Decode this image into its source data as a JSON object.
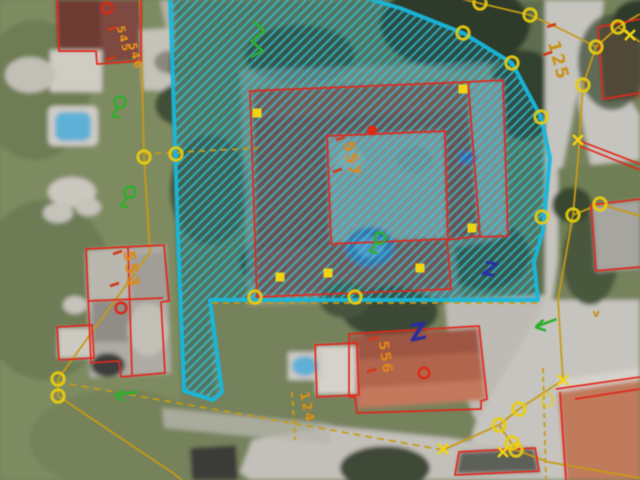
{
  "map": {
    "type": "cadastral-aerial-orthophoto",
    "colors": {
      "selection_border": "#17b9de",
      "selection_hatch": "#35cde8",
      "boundary_line": "#c79a17",
      "building_outline": "#e3271c",
      "marker_yellow": "#f2d414",
      "marker_ring": "#e8cd10",
      "building_ring_red": "#e02714",
      "vegetation_green": "#2fae2e",
      "annotation_blue": "#2a2fa0",
      "label_orange": "#e08818"
    },
    "parcel_labels": [
      {
        "text": "125",
        "x": 553,
        "y": 62,
        "rot": 75,
        "size": 17,
        "color": "#c7921a",
        "ticks": [
          [
            547,
            27
          ],
          [
            543,
            55
          ]
        ]
      },
      {
        "text": "553",
        "x": 126,
        "y": 270,
        "rot": 82,
        "size": 16,
        "color": "#e08818",
        "ticks": [
          [
            113,
            254
          ],
          [
            110,
            286
          ]
        ]
      },
      {
        "text": "557",
        "x": 347,
        "y": 160,
        "rot": 78,
        "size": 15,
        "color": "#e08818",
        "ticks": [
          [
            336,
            140
          ],
          [
            333,
            172
          ]
        ]
      },
      {
        "text": "556",
        "x": 381,
        "y": 358,
        "rot": 82,
        "size": 14,
        "color": "#e08818",
        "ticks": [
          [
            369,
            340
          ],
          [
            367,
            372
          ]
        ]
      },
      {
        "text": "124",
        "x": 303,
        "y": 408,
        "rot": 78,
        "size": 13,
        "color": "#d89010",
        "ticks": []
      },
      {
        "text": "545",
        "x": 120,
        "y": 40,
        "rot": 76,
        "size": 11,
        "color": "#e89418",
        "ticks": [
          [
            108,
            30
          ]
        ]
      },
      {
        "text": "546",
        "x": 132,
        "y": 57,
        "rot": 76,
        "size": 11,
        "color": "#e89418",
        "ticks": [
          [
            106,
            60
          ]
        ]
      },
      {
        "text": "v",
        "x": 597,
        "y": 317,
        "rot": 0,
        "size": 11,
        "color": "#c78a14",
        "ticks": []
      }
    ],
    "symbols": [
      {
        "name": "orchard-tree-symbol",
        "x": 120,
        "y": 102,
        "rot": -15
      },
      {
        "name": "orchard-tree-symbol",
        "x": 130,
        "y": 192,
        "rot": -10
      },
      {
        "name": "orchard-tree-symbol",
        "x": 380,
        "y": 238,
        "rot": -5
      },
      {
        "name": "vegetation-zigzag-symbol",
        "x": 257,
        "y": 40,
        "rot": 8
      },
      {
        "name": "arrow-left-symbol",
        "x": 123,
        "y": 394,
        "rot": 3
      },
      {
        "name": "arrow-left-symbol",
        "x": 543,
        "y": 324,
        "rot": -8
      },
      {
        "name": "annotation-letter",
        "glyph": "Z",
        "x": 489,
        "y": 276,
        "rot": 8,
        "size": 20
      },
      {
        "name": "annotation-letter",
        "glyph": "Z",
        "x": 420,
        "y": 340,
        "rot": -12,
        "size": 24
      }
    ],
    "markers": {
      "vertex_rings": [
        [
          144,
          157
        ],
        [
          176,
          154
        ],
        [
          58,
          379
        ],
        [
          58,
          396
        ],
        [
          463,
          33
        ],
        [
          512,
          63
        ],
        [
          541,
          117
        ],
        [
          542,
          217
        ],
        [
          530,
          15
        ],
        [
          480,
          3
        ],
        [
          618,
          27
        ],
        [
          596,
          47
        ],
        [
          583,
          85
        ],
        [
          573,
          215
        ],
        [
          600,
          204
        ],
        [
          519,
          409
        ],
        [
          499,
          425
        ],
        [
          512,
          443
        ],
        [
          516,
          450
        ],
        [
          547,
          400,
          0.45
        ],
        [
          355,
          297
        ],
        [
          255,
          297
        ]
      ],
      "crosses": [
        [
          630,
          35
        ],
        [
          578,
          140
        ],
        [
          563,
          380
        ],
        [
          503,
          452
        ],
        [
          443,
          449
        ]
      ],
      "squares": [
        [
          257,
          113
        ],
        [
          463,
          89
        ],
        [
          472,
          228
        ],
        [
          420,
          268
        ],
        [
          328,
          273
        ],
        [
          280,
          277
        ]
      ],
      "building_rings": [
        [
          107,
          8
        ],
        [
          121,
          308
        ],
        [
          424,
          373
        ]
      ],
      "building_dots": [
        [
          372,
          130
        ]
      ]
    }
  }
}
